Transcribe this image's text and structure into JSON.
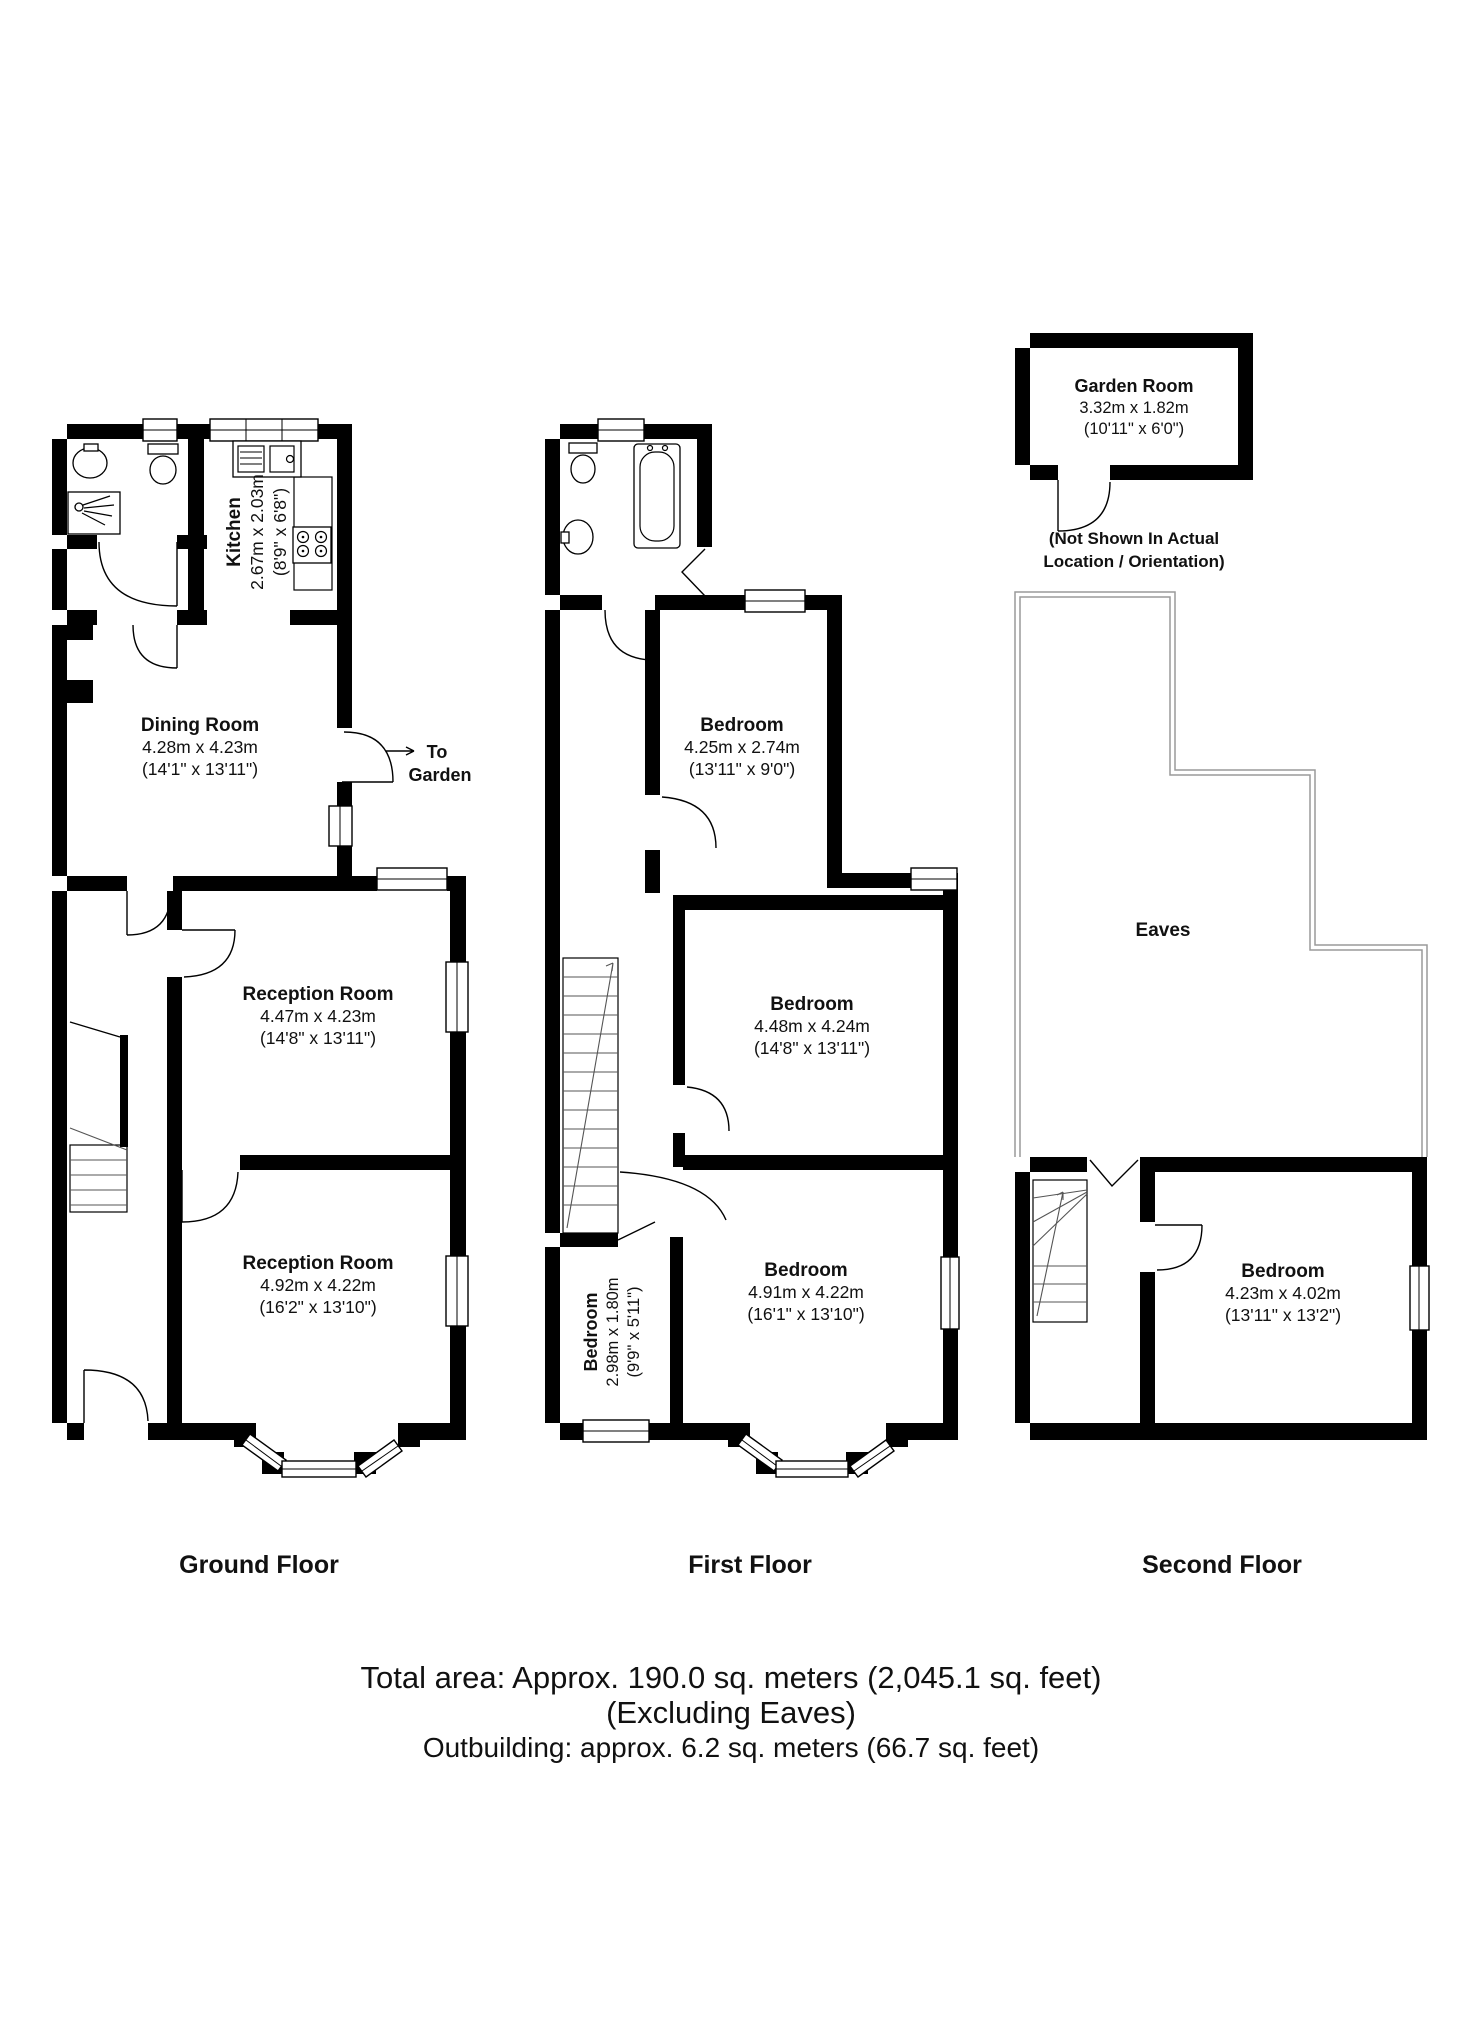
{
  "labels": {
    "ground": "Ground Floor",
    "first": "First Floor",
    "second": "Second Floor"
  },
  "ground": {
    "kitchen": {
      "name": "Kitchen",
      "metric": "2.67m x 2.03m",
      "imperial": "(8'9\" x 6'8\")"
    },
    "dining": {
      "name": "Dining Room",
      "metric": "4.28m x 4.23m",
      "imperial": "(14'1\" x 13'11\")"
    },
    "reception1": {
      "name": "Reception Room",
      "metric": "4.47m x 4.23m",
      "imperial": "(14'8\" x 13'11\")"
    },
    "reception2": {
      "name": "Reception Room",
      "metric": "4.92m x 4.22m",
      "imperial": "(16'2\" x 13'10\")"
    },
    "garden_exit": {
      "line1": "To",
      "line2": "Garden"
    }
  },
  "first": {
    "bedroom_top": {
      "name": "Bedroom",
      "metric": "4.25m x 2.74m",
      "imperial": "(13'11\" x 9'0\")"
    },
    "bedroom_middle": {
      "name": "Bedroom",
      "metric": "4.48m x 4.24m",
      "imperial": "(14'8\" x 13'11\")"
    },
    "bedroom_large": {
      "name": "Bedroom",
      "metric": "4.91m x 4.22m",
      "imperial": "(16'1\" x 13'10\")"
    },
    "bedroom_small": {
      "name": "Bedroom",
      "metric": "2.98m x 1.80m",
      "imperial": "(9'9\" x 5'11\")"
    }
  },
  "second": {
    "garden_room": {
      "name": "Garden Room",
      "metric": "3.32m x 1.82m",
      "imperial": "(10'11\" x 6'0\")"
    },
    "note": {
      "line1": "(Not Shown In Actual",
      "line2": "Location / Orientation)"
    },
    "eaves_label": "Eaves",
    "bedroom": {
      "name": "Bedroom",
      "metric": "4.23m x 4.02m",
      "imperial": "(13'11\" x 13'2\")"
    }
  },
  "footer": {
    "total_area": "Total area: Approx. 190.0 sq. meters (2,045.1 sq. feet)",
    "excluding": "(Excluding Eaves)",
    "outbuilding": "Outbuilding: approx. 6.2 sq. meters (66.7 sq. feet)"
  },
  "colors": {
    "wall": "#000000",
    "eaves_outline": "#9a9a9a",
    "background": "#ffffff",
    "text": "#111111"
  }
}
